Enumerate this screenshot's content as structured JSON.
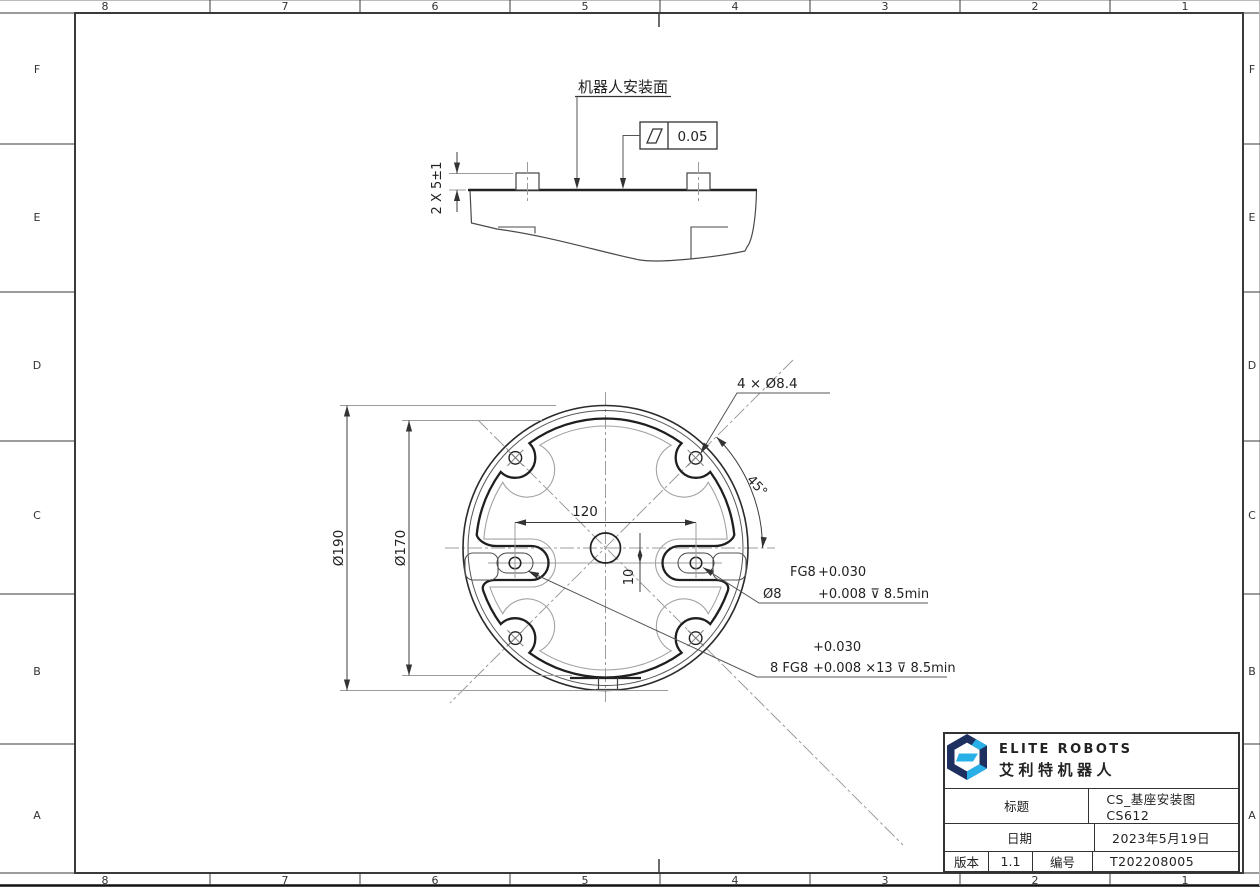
{
  "border": {
    "col_labels": [
      "8",
      "7",
      "6",
      "5",
      "4",
      "3",
      "2",
      "1"
    ],
    "row_labels": [
      "F",
      "E",
      "D",
      "C",
      "B",
      "A"
    ]
  },
  "side_view": {
    "surface_label": "机器人安装面",
    "pin_dim": "2 X 5±1",
    "flatness_value": "0.05"
  },
  "top_view": {
    "holes_callout": "4 × Ø8.4",
    "dim_spacing": "120",
    "dim_offset": "10",
    "dim_angle": "45°",
    "dim_outer": "Ø190",
    "dim_bolt_circle": "Ø170",
    "fit_callout": {
      "name": "FG8",
      "upper": "+0.030",
      "dia": "Ø8",
      "lower": "+0.008 ⊽ 8.5min"
    },
    "fit_callout_8": {
      "prefix": "8 FG8",
      "upper": "+0.030",
      "lower": "+0.008 ×13 ⊽ 8.5min"
    }
  },
  "title_block": {
    "brand_en": "ELITE ROBOTS",
    "brand_cn": "艾利特机器人",
    "title_label": "标题",
    "title_value": "CS_基座安装图 CS612",
    "date_label": "日期",
    "date_value": "2023年5月19日",
    "version_label": "版本",
    "version_value": "1.1",
    "number_label": "编号",
    "number_value": "T202208005"
  },
  "colors": {
    "navy": "#1e3060",
    "cyan": "#29b0e6",
    "mid_blue": "#2f6fba",
    "line_dark": "#222222",
    "line_gray": "#9c9c9c"
  }
}
